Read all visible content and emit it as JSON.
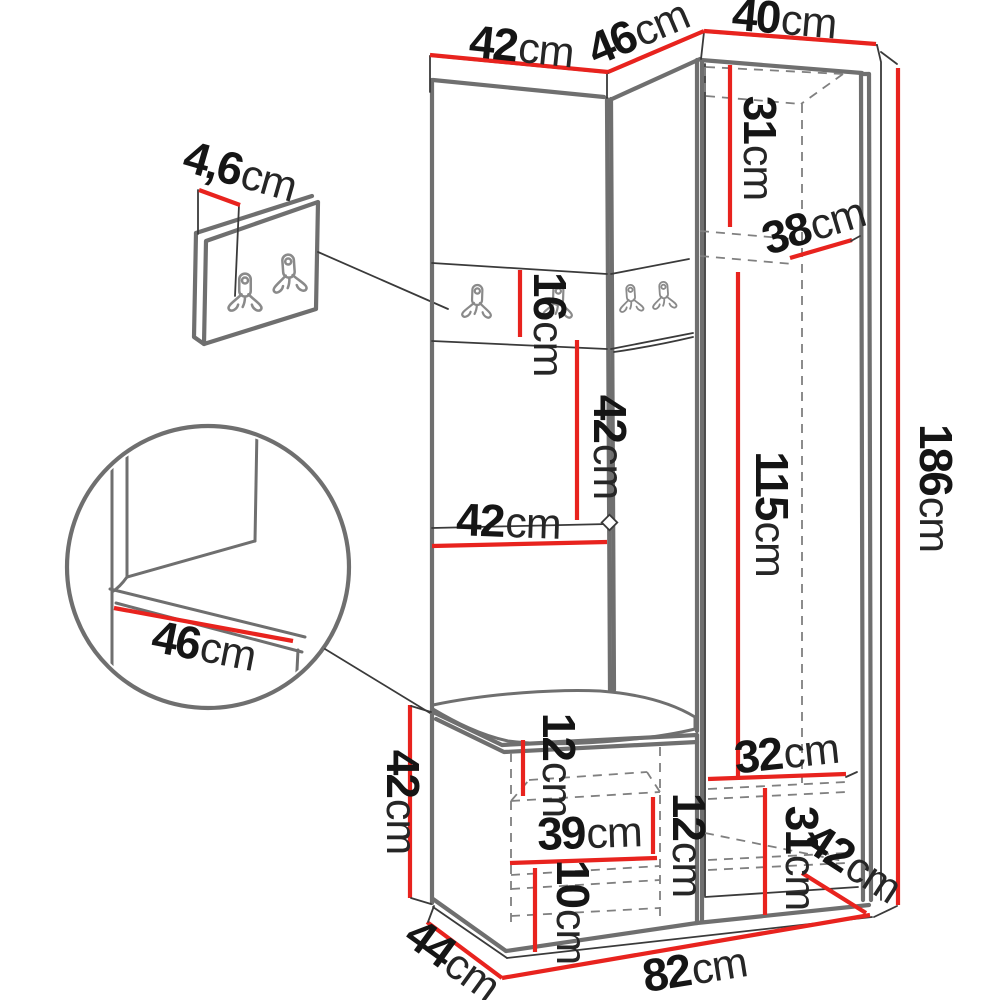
{
  "diagram": {
    "kind_label": "",
    "colors": {
      "dimension_red": "#e8231e",
      "outline_gray": "#6f6f6f",
      "line_dark": "#3a3a3a",
      "background": "#ffffff"
    }
  },
  "dims": {
    "top_left_width": {
      "value": "42",
      "unit": "cm"
    },
    "top_corner_width": {
      "value": "46",
      "unit": "cm"
    },
    "top_right_width": {
      "value": "40",
      "unit": "cm"
    },
    "right_upper_inner_height": {
      "value": "31",
      "unit": "cm"
    },
    "right_depth": {
      "value": "38",
      "unit": "cm"
    },
    "hook_strip_height": {
      "value": "16",
      "unit": "cm"
    },
    "coat_space_height": {
      "value": "42",
      "unit": "cm"
    },
    "coat_space_width": {
      "value": "42",
      "unit": "cm"
    },
    "right_inner_height": {
      "value": "115",
      "unit": "cm"
    },
    "total_height": {
      "value": "186",
      "unit": "cm"
    },
    "panel_thickness": {
      "value": "4,6",
      "unit": "cm"
    },
    "seat_depth_detail": {
      "value": "46",
      "unit": "cm"
    },
    "bench_height": {
      "value": "42",
      "unit": "cm"
    },
    "seat_thickness": {
      "value": "12",
      "unit": "cm"
    },
    "bench_inner_width": {
      "value": "39",
      "unit": "cm"
    },
    "bench_shelf_height": {
      "value": "12",
      "unit": "cm"
    },
    "bench_lower_height": {
      "value": "10",
      "unit": "cm"
    },
    "shoe_space_width": {
      "value": "32",
      "unit": "cm"
    },
    "shoe_space_height": {
      "value": "31",
      "unit": "cm"
    },
    "shoe_space_diagonal": {
      "value": "42",
      "unit": "cm"
    },
    "total_width": {
      "value": "82",
      "unit": "cm"
    },
    "bench_depth": {
      "value": "44",
      "unit": "cm"
    }
  }
}
